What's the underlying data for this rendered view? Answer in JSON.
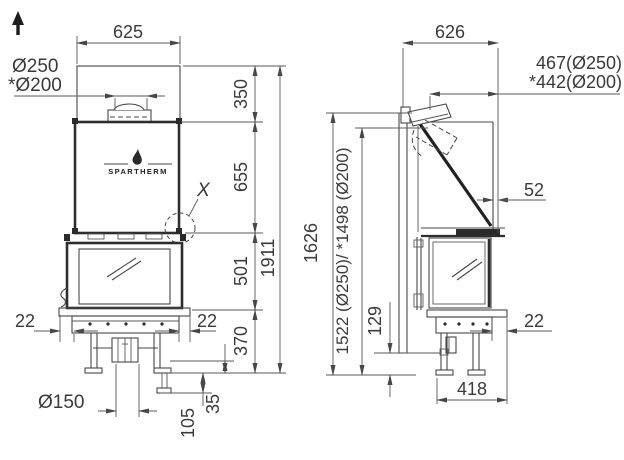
{
  "front_view": {
    "width_top": "625",
    "flue_large": "Ø250",
    "flue_small": "*Ø200",
    "brand": "SPARTHERM",
    "detail_marker": "X",
    "seg_hood": "350",
    "seg_firebox": "655",
    "seg_door": "501",
    "seg_base": "370",
    "total_height": "1911",
    "offset_left": "22",
    "offset_right": "22",
    "floor_flue": "Ø150",
    "adjust_small": "35",
    "adjust_large": "105"
  },
  "side_view": {
    "depth_top": "626",
    "flue_setback_large": "467(Ø250)",
    "flue_setback_small": "*442(Ø200)",
    "front_gap": "52",
    "height_shield": "1626",
    "height_flue": "1522 (Ø250)/ *1498 (Ø200)",
    "base_clearance": "129",
    "base_depth": "418",
    "offset_front": "22"
  }
}
